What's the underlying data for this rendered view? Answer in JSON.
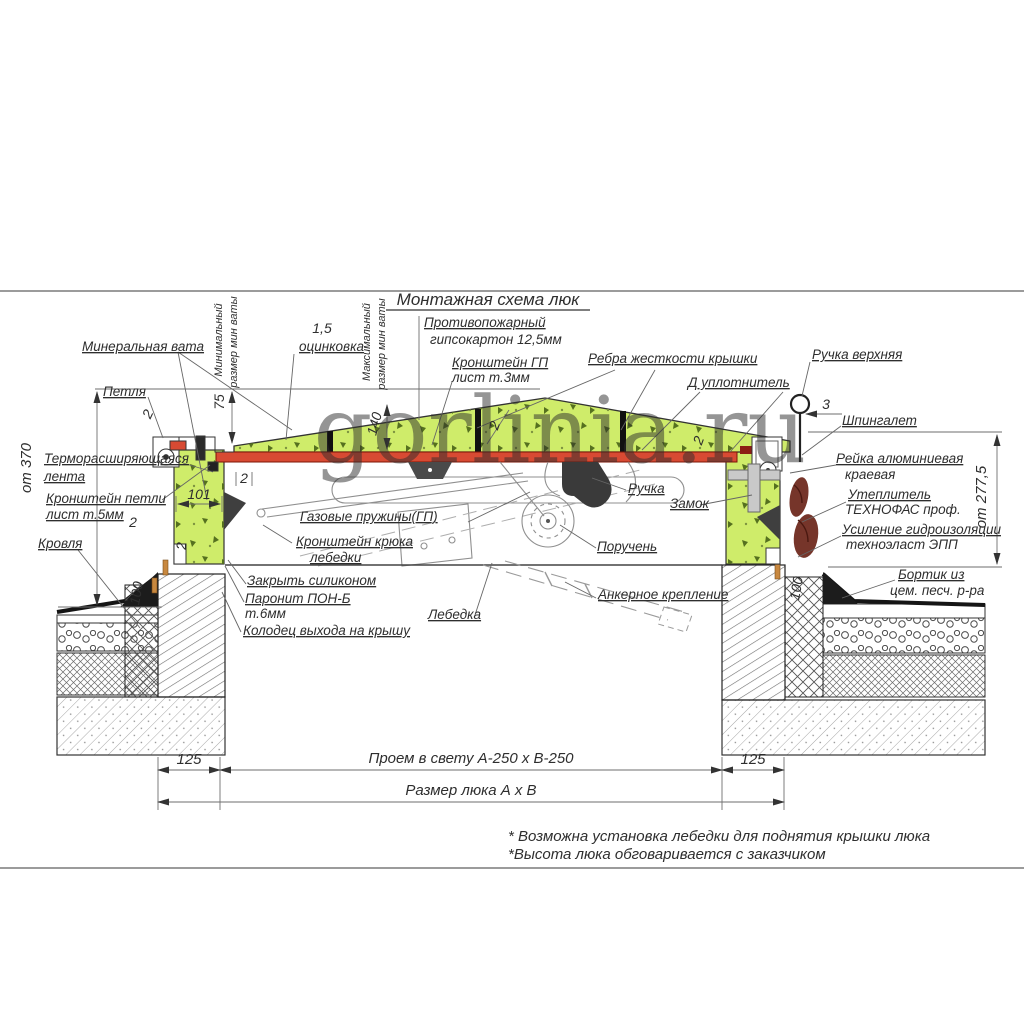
{
  "watermark": "gorlinia.ru",
  "labels": {
    "title": "Монтажная схема люк",
    "mineral_wool": "Минеральная вата",
    "min_word": "Минимальный",
    "max_word": "Максимальный",
    "wool_size": "размер мин ваты",
    "zinc_value": "1,5",
    "zinc": "оцинковка",
    "fireproof1": "Противопожарный",
    "fireproof2": "гипсокартон 12,5мм",
    "gp_bracket1": "Кронштейн ГП",
    "gp_bracket2": "лист т.3мм",
    "ribs": "Ребра жесткости крышки",
    "seal": "Д уплотнитель",
    "top_handle": "Ручка верхняя",
    "latch": "Шпингалет",
    "hinge": "Петля",
    "thermo1": "Терморасширяющаяся",
    "thermo2": "лента",
    "hinge_bracket1": "Кронштейн петли",
    "hinge_bracket2": "лист т.5мм",
    "roof": "Кровля",
    "gas_springs": "Газовые пружины(ГП)",
    "hook_bracket1": "Кронштейн крюка",
    "hook_bracket2": "лебедки",
    "handle": "Ручка",
    "lock": "Замок",
    "handrail": "Поручень",
    "silicone": "Закрыть силиконом",
    "paronite1": "Паронит ПОН-Б",
    "paronite2": "т.6мм",
    "well": "Колодец выхода на крышу",
    "winch": "Лебедка",
    "anchor": "Анкерное крепление",
    "alu_rail1": "Рейка алюминиевая",
    "alu_rail2": "краевая",
    "insul1": "Утеплитель",
    "insul2": "ТЕХНОФАС проф.",
    "hydro1": "Усиление гидроизоляции",
    "hydro2": "техноэласт ЭПП",
    "curb1": "Бортик из",
    "curb2": "цем. песч. р-ра"
  },
  "dimensions": {
    "d2": "2",
    "d3": "3",
    "d75": "75",
    "d101": "101",
    "d140": "140",
    "d100": "100",
    "d125": "125",
    "h_left": "от 370",
    "h_right": "от 277,5",
    "opening": "Проем в свету А-250 х В-250",
    "hatch_size": "Размер люка А х В"
  },
  "notes": {
    "note1": "* Возможна установка лебедки для поднятия крышки люка",
    "note2": "*Высота люка обговаривается с заказчиком"
  },
  "colors": {
    "insulation": "#cfec6a",
    "speckle": "#55701f",
    "sheet": "#d84a33",
    "sheet_border": "#7e1606",
    "watermark": "#8cc480",
    "handle_brown": "#76352a",
    "pin_orange": "#c8883f",
    "line": "#3c3c3c"
  }
}
